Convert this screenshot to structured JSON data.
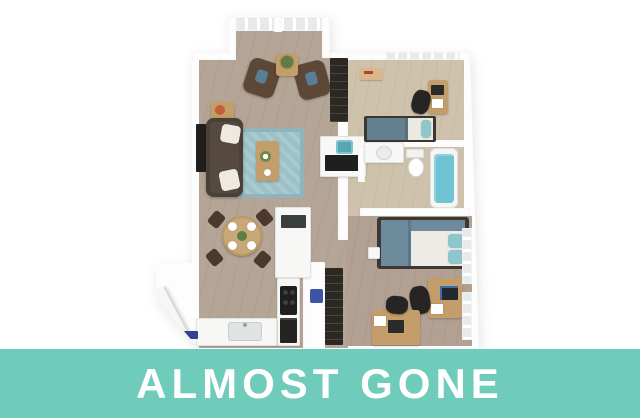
{
  "banner": {
    "label": "ALMOST GONE",
    "background_color": "#6fcbba",
    "text_color": "#ffffff"
  },
  "floor_plan": {
    "description": "3D isometric rendering of a two-bedroom apartment floor plan",
    "rooms": [
      {
        "name": "entry-nook"
      },
      {
        "name": "living-room"
      },
      {
        "name": "dining-area"
      },
      {
        "name": "kitchen"
      },
      {
        "name": "bedroom-1"
      },
      {
        "name": "bathroom"
      },
      {
        "name": "bedroom-2"
      },
      {
        "name": "entry"
      }
    ],
    "palette": {
      "wall": "#fdfdfd",
      "floor_wood": "#b4a597",
      "floor_bedroom1": "#cfc2ad",
      "floor_bedroom2": "#b2a192",
      "rug": "#9dc1c8",
      "sofa": "#564a40",
      "armchair": "#5d4736",
      "wood_furniture": "#c49e6a",
      "bedding_blue": "#6d8b9c",
      "accent_teal": "#8fc6cb",
      "tub_water": "#6fc3d3",
      "dark_fixture": "#2c2824",
      "door_mat_blue": "#33448e"
    }
  }
}
